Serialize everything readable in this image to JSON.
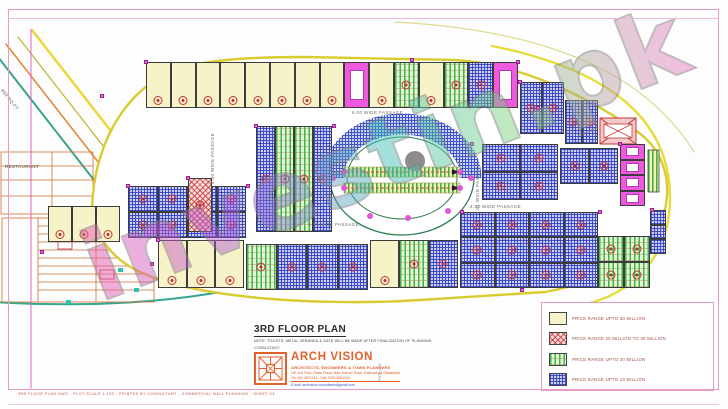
{
  "sheet": {
    "title": "3RD FLOOR PLAN",
    "note": "NOTE: TOILETS, METAL VERANDA & GATE WILL BE MADE AFTER FINALIZATION OF PLANNING",
    "consultant_label": "CONSULTANT:",
    "firm": {
      "name": "ARCH VISION",
      "tagline": "ARCHITECTS, ENGINEERS & TOWN PLANNERS",
      "address_line1": "Off: 2nd Floor, Rania Plaza, Main Murree Road, Shamsabad, Rawalpindi",
      "address_line2": "Tel: 051-4571234  -  Cell: 0300-5551234",
      "email_line": "E-mail: archvision.consultants@gmail.com",
      "registration_vertical": "(PVT.) LTD."
    },
    "plot_stamp": "3RD FLOOR PLAN.DWG - PLOT SCALE 1:100 - PRINTED BY CONSULTANT - COMMERCIAL MALL PLANNING - SHEET 03"
  },
  "watermark": {
    "text": "investin.pk"
  },
  "legend": {
    "items": [
      {
        "label": "PRICE RANGE UPTO 30 MILLION",
        "pattern": "solid-yellow",
        "swatch_color": "#f7f3c8"
      },
      {
        "label": "PRICE RANGE 20 MILLION TO 30 MILLION",
        "pattern": "red-crosshatch",
        "swatch_color": "#cd3c3c"
      },
      {
        "label": "PRICE RANGE UPTO 20 MILLION",
        "pattern": "green-stripes",
        "swatch_color": "#44b244"
      },
      {
        "label": "PRICE RANGE UPTO 10 MILLION",
        "pattern": "blue-grid",
        "swatch_color": "#2a3ebe"
      }
    ]
  },
  "plan_labels": {
    "passage_top": "6.00 WIDE PASSAGE",
    "passage_left": "4.00 WIDE PASSAGE",
    "passage_center": "5.25 WIDE PASSAGE",
    "passage_right": "7.01 WIDE PASSAGE",
    "passage_bottom": "4.50 WIDE PASSAGE",
    "road_plot_area": "630 SQ.FT",
    "restaurant": "RESTAURANT"
  },
  "colors": {
    "border_pink": "#e79ac6",
    "building_outline_yellow": "#d9cc31",
    "firm_orange": "#e2622e",
    "marker_red": "#c23333",
    "grip_magenta": "#ef5fe0"
  }
}
